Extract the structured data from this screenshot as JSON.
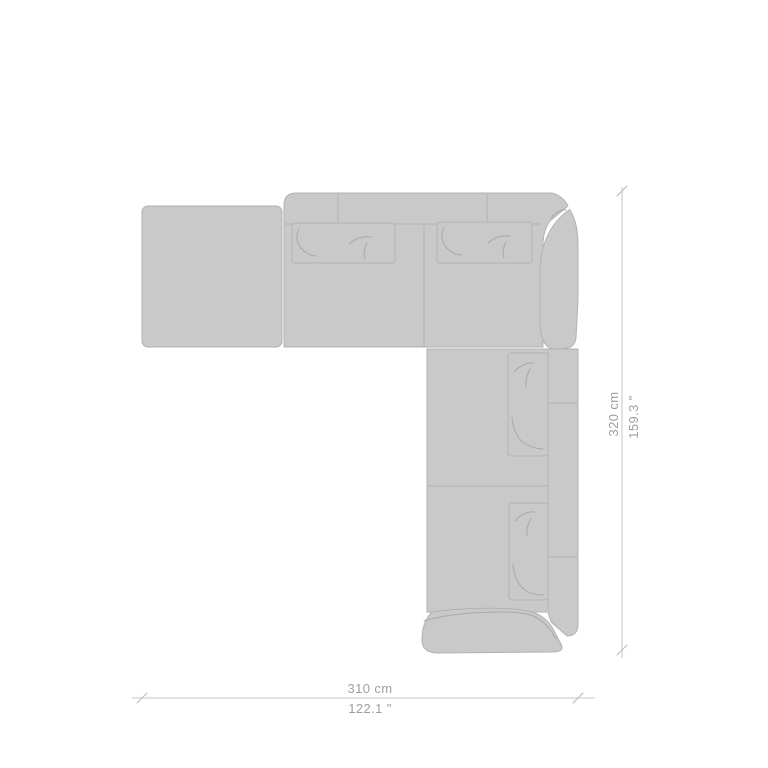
{
  "figure": {
    "description": "Top view plan drawing of an L-shaped corner sectional sofa with chaise, two back cushions on the top section, two back cushions on the right section, a corner back cushion and an end armrest cushion",
    "colors": {
      "background": "#ffffff",
      "sofa_fill": "#c9c9c9",
      "sofa_outline": "#b2b2b2",
      "wrinkle_line": "#a8a8a8",
      "dimension_line": "#c6c6c6",
      "dimension_text": "#9e9e9e"
    }
  },
  "dimensions": {
    "width": {
      "cm": "310 cm",
      "inches": "122.1 \""
    },
    "height": {
      "cm": "320 cm",
      "inches": "159.3 \""
    }
  }
}
